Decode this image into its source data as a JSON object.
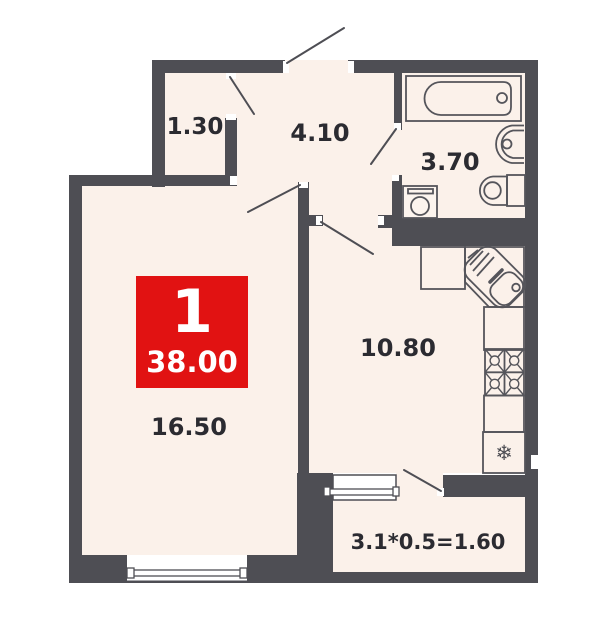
{
  "plan": {
    "type": "apartment-floor-plan",
    "badge": {
      "room_count": "1",
      "total_area": "38.00"
    },
    "rooms": {
      "closet": {
        "area": "1.30"
      },
      "hallway": {
        "area": "4.10"
      },
      "bathroom": {
        "area": "3.70"
      },
      "kitchen": {
        "area": "10.80"
      },
      "living": {
        "area": "16.50"
      },
      "balcony": {
        "area": "3.1*0.5=1.60"
      }
    },
    "icons": {
      "refrigerator_snowflake": "❄"
    },
    "colors": {
      "wall": "#4e4e54",
      "floor": "#fbf1ea",
      "accent": "#e11212",
      "label_text": "#2b2b31"
    }
  }
}
